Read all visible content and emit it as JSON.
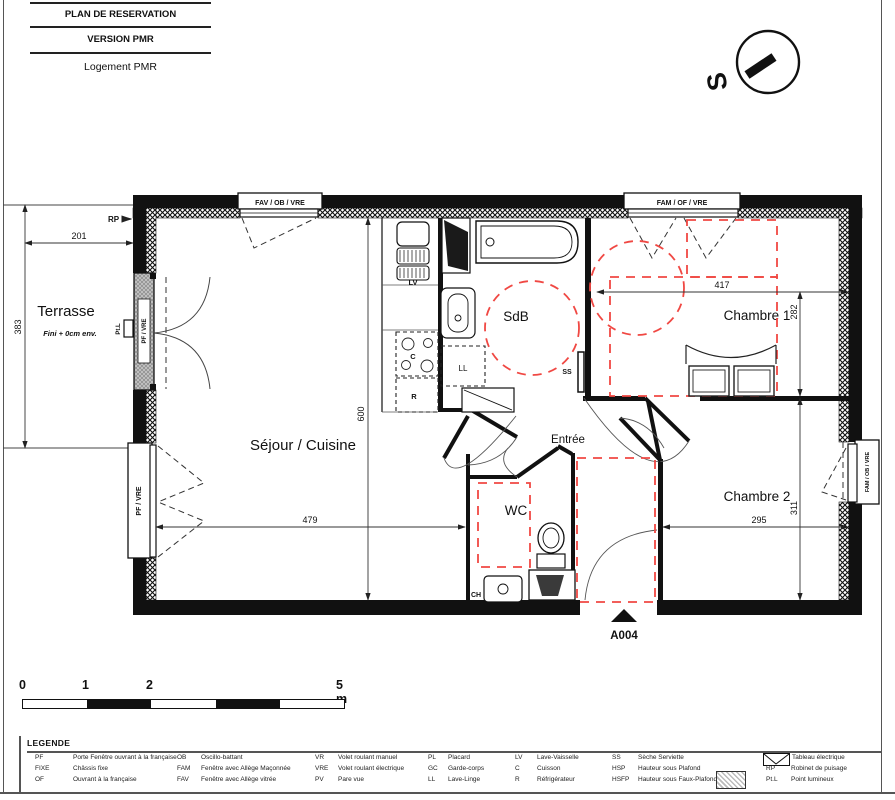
{
  "title_block": {
    "line1": "PLAN DE RESERVATION",
    "line2": "VERSION PMR",
    "line3": "Logement PMR"
  },
  "compass": {
    "letter": "S"
  },
  "plan": {
    "rooms": {
      "terrasse": "Terrasse",
      "terrasse_note": "Fini + 0cm env.",
      "sejour": "Séjour / Cuisine",
      "sdb": "SdB",
      "entree": "Entrée",
      "wc": "WC",
      "chambre1": "Chambre 1",
      "chambre2": "Chambre 2"
    },
    "dims": {
      "terrasse_w": "201",
      "terrasse_h": "383",
      "sejour_h": "600",
      "sejour_w": "479",
      "ch1_w": "417",
      "ch1_h": "282",
      "ch2_w": "295",
      "ch2_h": "311"
    },
    "windows": {
      "top_left": "FAV / OB / VRE",
      "top_right": "FAM / OF / VRE",
      "left_upper": "PF / VRE",
      "left_lower": "PF / VRE",
      "right": "FAM / OB / VRE"
    },
    "annotations": {
      "rp": "RP",
      "ptl": "Pt.L",
      "lv": "LV",
      "cuisson": "C",
      "refrigerateur": "R",
      "lavelinge": "LL",
      "ss": "SS",
      "ch": "CH",
      "entry_door": "A004"
    },
    "colors": {
      "accent_red": "#f04843",
      "wall_black": "#111111"
    }
  },
  "scale_bar": {
    "ticks": [
      "0",
      "1",
      "2"
    ],
    "end": "5 m"
  },
  "legend": {
    "title": "LEGENDE",
    "columns": [
      [
        {
          "abbr": "PF",
          "label": "Porte Fenêtre ouvrant à la française"
        },
        {
          "abbr": "FIXE",
          "label": "Châssis fixe"
        },
        {
          "abbr": "OF",
          "label": "Ouvrant à la française"
        }
      ],
      [
        {
          "abbr": "OB",
          "label": "Oscillo-battant"
        },
        {
          "abbr": "FAM",
          "label": "Fenêtre avec Allège Maçonnée"
        },
        {
          "abbr": "FAV",
          "label": "Fenêtre avec Allège vitrée"
        }
      ],
      [
        {
          "abbr": "VR",
          "label": "Volet roulant manuel"
        },
        {
          "abbr": "VRE",
          "label": "Volet roulant électrique"
        },
        {
          "abbr": "PV",
          "label": "Pare vue"
        }
      ],
      [
        {
          "abbr": "PL",
          "label": "Placard"
        },
        {
          "abbr": "GC",
          "label": "Garde-corps"
        },
        {
          "abbr": "LL",
          "label": "Lave-Linge"
        }
      ],
      [
        {
          "abbr": "LV",
          "label": "Lave-Vaisselle"
        },
        {
          "abbr": "C",
          "label": "Cuisson"
        },
        {
          "abbr": "R",
          "label": "Réfrigérateur"
        }
      ],
      [
        {
          "abbr": "SS",
          "label": "Sèche Serviette"
        },
        {
          "abbr": "HSP",
          "label": "Hauteur sous Plafond"
        },
        {
          "abbr": "HSFP",
          "label": "Hauteur sous Faux-Plafond"
        }
      ],
      [
        {
          "abbr": "",
          "label": "Tableau électrique"
        },
        {
          "abbr": "RP",
          "label": "Robinet de puisage"
        },
        {
          "abbr": "Pt.L",
          "label": "Point lumineux"
        }
      ]
    ]
  }
}
